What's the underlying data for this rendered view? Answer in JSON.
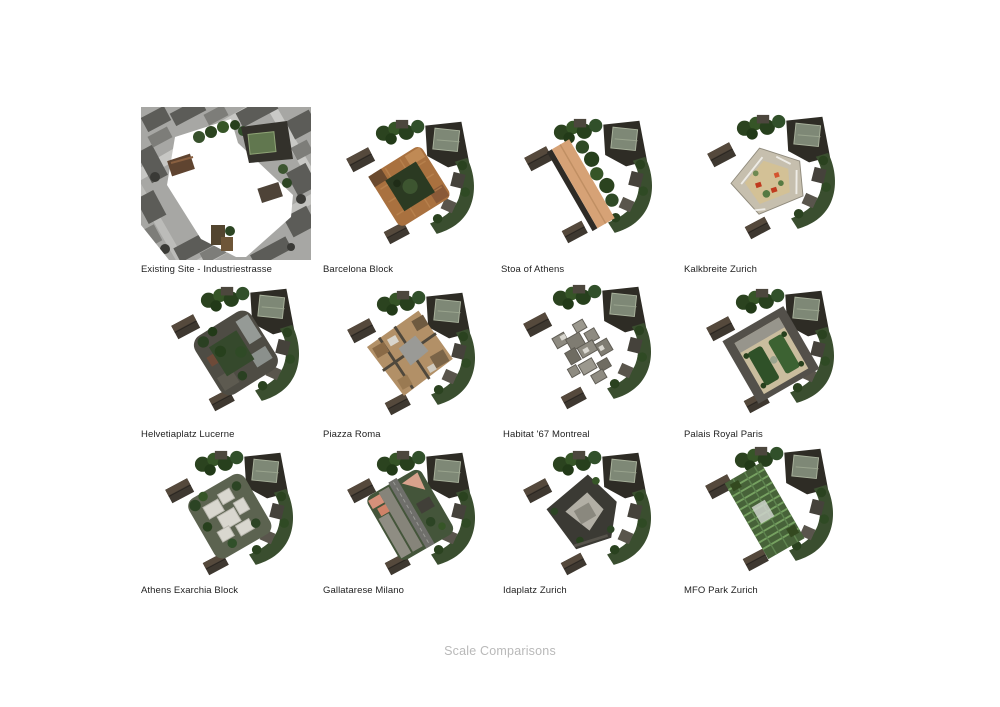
{
  "sheet": {
    "title": "Scale Comparisons",
    "colors": {
      "background": "#ffffff",
      "caption_text": "#1f1f1f",
      "title_text": "#b9b9b9",
      "vegetation_green": "#2e4a26",
      "roof_terracotta": "#a9713f",
      "stoa_tan": "#d6a276",
      "lawn_green": "#2f5128",
      "courtyard_sand": "#d3c196",
      "accent_red": "#c03a1e"
    },
    "tiles": [
      {
        "label": "Existing Site - Industriestrasse"
      },
      {
        "label": "Barcelona Block"
      },
      {
        "label": "Stoa of Athens"
      },
      {
        "label": "Kalkbreite Zurich"
      },
      {
        "label": "Helvetiaplatz Lucerne"
      },
      {
        "label": "Piazza Roma"
      },
      {
        "label": "Habitat '67 Montreal"
      },
      {
        "label": "Palais Royal Paris"
      },
      {
        "label": "Athens Exarchia Block"
      },
      {
        "label": "Gallatarese Milano"
      },
      {
        "label": "Idaplatz Zurich"
      },
      {
        "label": "MFO Park Zurich"
      }
    ]
  }
}
